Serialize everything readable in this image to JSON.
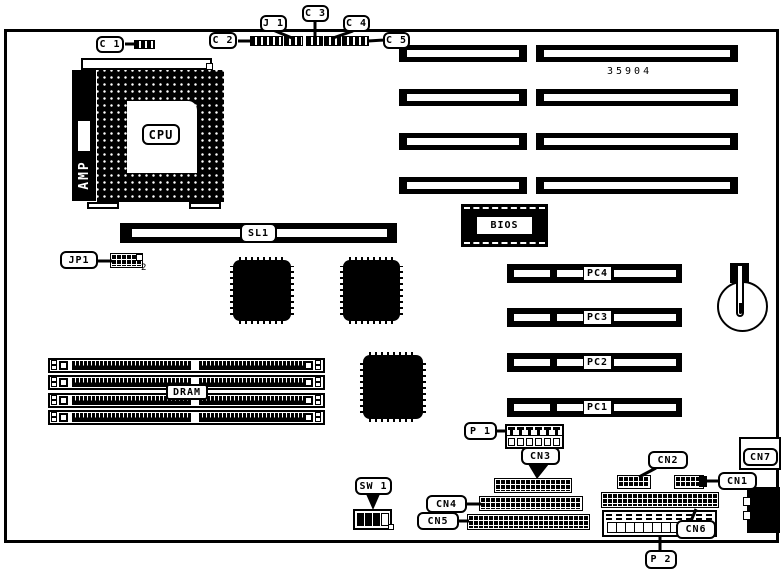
{
  "board": {
    "part_number": "35904"
  },
  "chips": {
    "cpu": "CPU",
    "cpu_bracket": "AMP",
    "bios": "BIOS"
  },
  "slots": {
    "sl1": "SL1",
    "dram": "DRAM",
    "pc1": "PC1",
    "pc2": "PC2",
    "pc3": "PC3",
    "pc4": "PC4"
  },
  "callouts": {
    "c1": "C 1",
    "c2": "C 2",
    "j1": "J 1",
    "c3": "C 3",
    "c4": "C 4",
    "c5": "C 5",
    "jp1": "JP1",
    "jp1_pin": "2",
    "sw1": "SW 1",
    "p1": "P 1",
    "p2": "P 2",
    "cn1": "CN1",
    "cn2": "CN2",
    "cn3": "CN3",
    "cn4": "CN4",
    "cn5": "CN5",
    "cn6": "CN6",
    "cn7": "CN7"
  },
  "colors": {
    "ink": "#000000",
    "paper": "#ffffff"
  }
}
